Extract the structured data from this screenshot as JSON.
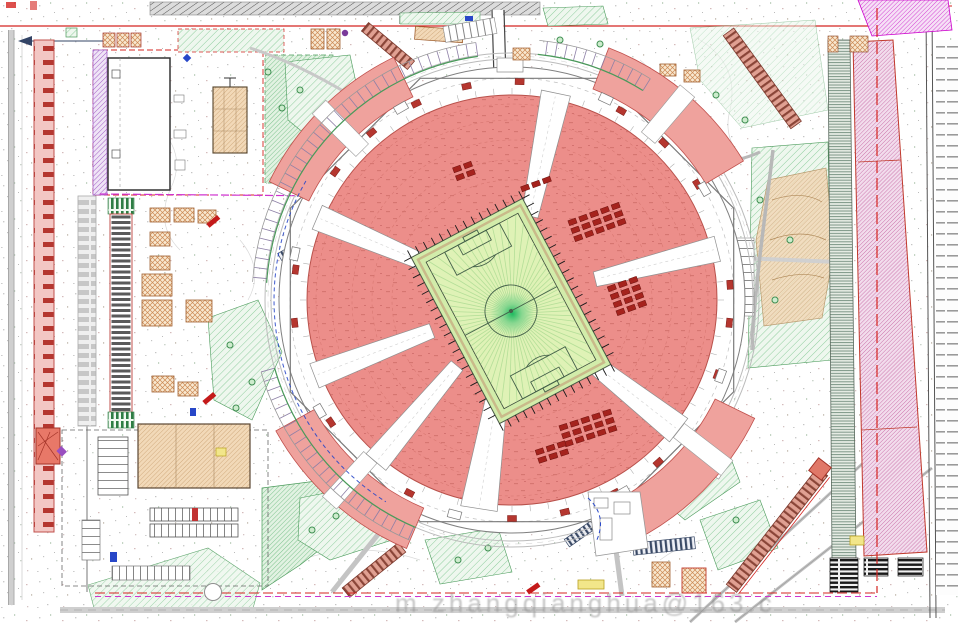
{
  "watermark": {
    "text": "m zhangqianghua@163.c"
  },
  "colors": {
    "paper": "#ffffff",
    "boundary_red": "#d42420",
    "bowl_red": "#ec8e8a",
    "plaza_red": "#efa29d",
    "seat_block_red": "#a5231d",
    "pitch_green": "#dff2b6",
    "apron_green": "#d2ecaa",
    "pitch_glow": "#18b85c",
    "lawn_hatch_green": "#8fce9e",
    "tan_fill": "#f2d9b8",
    "orange_hatch": "#cc8a55",
    "purple": "#9a4fc0",
    "magenta": "#cf33cf",
    "road_gray": "#9a9a9a",
    "pink_parking_hatch": "#c96da6",
    "gray_green_strip": "#7d9687",
    "accent_blue": "#2847c8",
    "accent_yellow": "#f2e68a"
  },
  "features": [
    "stadium-bowl",
    "football-pitch",
    "concourse-ring",
    "corner-plazas",
    "north-west-building-compound",
    "south-west-service-compound",
    "west-canopy-structure",
    "east-parking-strips",
    "site-boundary",
    "access-ramps",
    "landscape-green-areas"
  ]
}
